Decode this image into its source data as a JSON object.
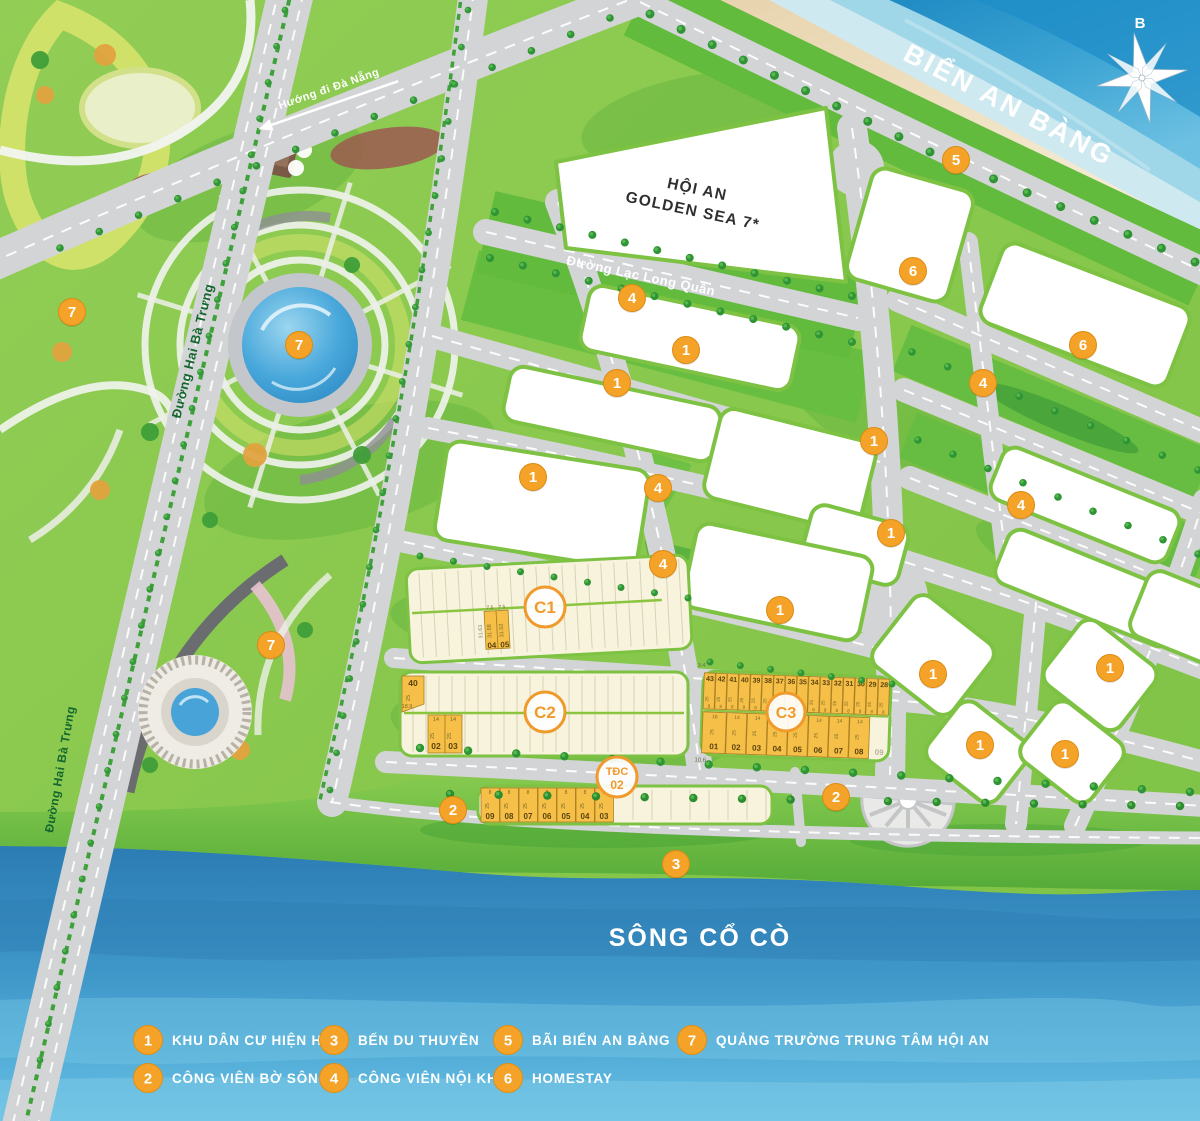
{
  "map": {
    "sea_label": "BIỂN AN BÀNG",
    "river_label": "SÔNG CỔ CÒ",
    "compass_label": "B",
    "landmark": {
      "line1": "HỘI AN",
      "line2": "GOLDEN SEA 7*"
    },
    "road_labels": [
      {
        "id": "duong-hai-ba-trung-upper",
        "text": "Đường Hai Bà Trưng",
        "x": 197,
        "y": 352,
        "rot": -76,
        "color": "#14672e",
        "size": 13
      },
      {
        "id": "duong-hai-ba-trung-lower",
        "text": "Đường Hai Bà Trưng",
        "x": 64,
        "y": 770,
        "rot": -80,
        "color": "#14672e",
        "size": 12
      },
      {
        "id": "duong-lac-long-quan",
        "text": "Đường Lạc Long Quân",
        "x": 640,
        "y": 280,
        "rot": 12,
        "color": "#ffffff",
        "size": 13
      },
      {
        "id": "huong-di-da-nang",
        "text": "Hướng đi Đà Nẵng",
        "x": 330,
        "y": 92,
        "rot": -19,
        "color": "#ffffff",
        "size": 11,
        "arrow": true
      }
    ],
    "markers": [
      {
        "n": "7",
        "x": 72,
        "y": 312
      },
      {
        "n": "7",
        "x": 299,
        "y": 345
      },
      {
        "n": "7",
        "x": 271,
        "y": 645
      },
      {
        "n": "4",
        "x": 632,
        "y": 298
      },
      {
        "n": "1",
        "x": 686,
        "y": 350
      },
      {
        "n": "1",
        "x": 617,
        "y": 383
      },
      {
        "n": "1",
        "x": 533,
        "y": 477
      },
      {
        "n": "4",
        "x": 658,
        "y": 488
      },
      {
        "n": "4",
        "x": 663,
        "y": 564
      },
      {
        "n": "1",
        "x": 780,
        "y": 610
      },
      {
        "n": "5",
        "x": 956,
        "y": 160
      },
      {
        "n": "6",
        "x": 913,
        "y": 271
      },
      {
        "n": "6",
        "x": 1083,
        "y": 345
      },
      {
        "n": "4",
        "x": 983,
        "y": 383
      },
      {
        "n": "1",
        "x": 874,
        "y": 441
      },
      {
        "n": "4",
        "x": 1021,
        "y": 505
      },
      {
        "n": "1",
        "x": 891,
        "y": 533
      },
      {
        "n": "1",
        "x": 933,
        "y": 674
      },
      {
        "n": "1",
        "x": 1110,
        "y": 668
      },
      {
        "n": "1",
        "x": 980,
        "y": 745
      },
      {
        "n": "1",
        "x": 1065,
        "y": 754
      },
      {
        "n": "2",
        "x": 453,
        "y": 810
      },
      {
        "n": "2",
        "x": 836,
        "y": 797
      },
      {
        "n": "3",
        "x": 676,
        "y": 864
      }
    ]
  },
  "blocks": {
    "c1": {
      "label": "C1",
      "adjacent_dim": "31.63",
      "highlight_lots": [
        {
          "num": "04",
          "dim": "31.58",
          "width": "7.5"
        },
        {
          "num": "05",
          "dim": "31.52",
          "width": "7.5"
        }
      ]
    },
    "c2": {
      "label": "C2",
      "corner_lot": {
        "num": "40",
        "depth": "25",
        "extra": "18.9"
      },
      "lots": [
        {
          "num": "02",
          "width": "14",
          "depth": "25"
        },
        {
          "num": "03",
          "width": "14",
          "depth": "25"
        }
      ]
    },
    "c3": {
      "label": "C3",
      "corner_dims": {
        "top": "3.4",
        "bottom": "10.6"
      },
      "top_row": {
        "nums": [
          "43",
          "42",
          "41",
          "40",
          "39",
          "38",
          "37",
          "36",
          "35",
          "34",
          "33",
          "32",
          "31",
          "30",
          "29",
          "28"
        ],
        "depth": "25",
        "width": "8"
      },
      "bottom_row": {
        "nums": [
          "01",
          "02",
          "03",
          "04",
          "05",
          "06",
          "07",
          "08"
        ],
        "widths": [
          "16",
          "14",
          "14",
          "14",
          "14",
          "14",
          "14",
          "14"
        ],
        "depth": "25",
        "extra_num": "09"
      }
    },
    "tdc": {
      "label_line1": "TĐC",
      "label_line2": "02",
      "lots": [
        "09",
        "08",
        "07",
        "06",
        "05",
        "04",
        "03"
      ],
      "width": "8",
      "depth": "25"
    }
  },
  "legend": {
    "items": [
      {
        "num": "1",
        "label": "KHU DÂN CƯ HIỆN HỮU"
      },
      {
        "num": "2",
        "label": "CÔNG VIÊN BỜ SÔNG"
      },
      {
        "num": "3",
        "label": "BẾN DU THUYỀN"
      },
      {
        "num": "4",
        "label": "CÔNG VIÊN NỘI KHU"
      },
      {
        "num": "5",
        "label": "BÃI BIỂN AN BÀNG"
      },
      {
        "num": "6",
        "label": "HOMESTAY"
      },
      {
        "num": "7",
        "label": "QUẢNG TRƯỜNG TRUNG TÂM HỘI AN"
      }
    ]
  },
  "colors": {
    "marker": "#f5a229",
    "marker_edge": "#dd8a10",
    "accent_orange": "#f09a2c",
    "road": "#d3d4d6",
    "grass": "#8cc84b",
    "verge": "#63bb3e",
    "tree": "#2f9435",
    "cream": "#f8f3dd",
    "lot_highlight": "#f5bf48",
    "lot_line": "#d8d2b4",
    "block_border": "#7dc242",
    "sea_deep": "#1f8ec7",
    "river_top": "#2b7cb3",
    "river_bottom": "#63bde2",
    "sand": "#ecd9b8"
  }
}
